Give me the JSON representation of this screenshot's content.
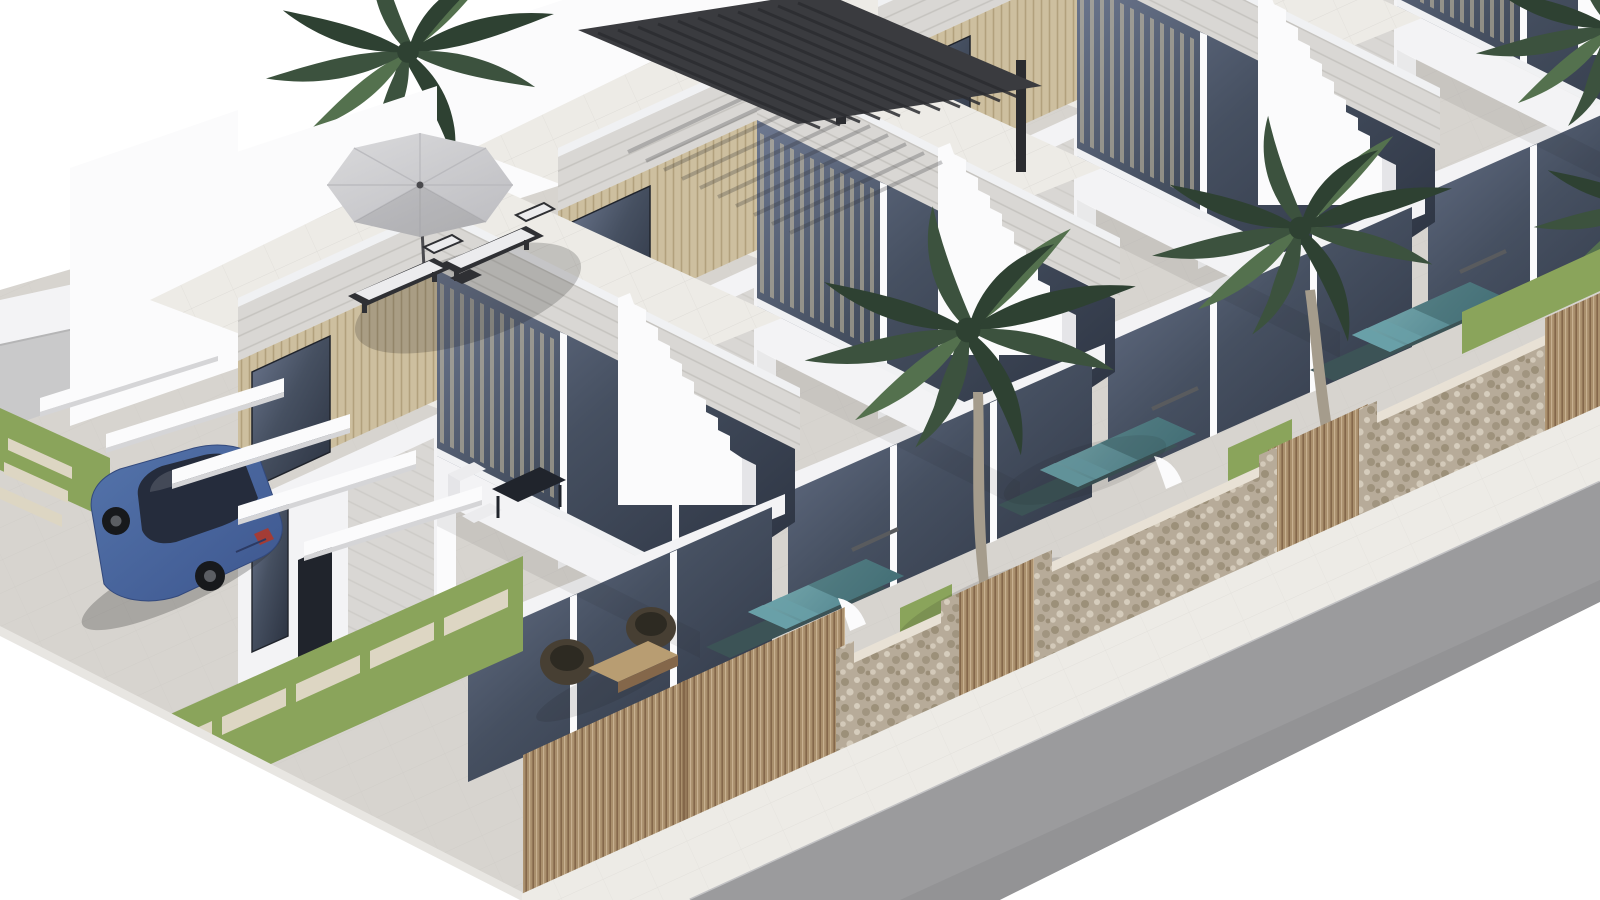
{
  "scene": {
    "type": "3d-architectural-render",
    "subject": "Row of four modern white two-storey villas with roof terraces, private plunge pools, palm trees, stone street walls, a parked blue car and a street in the lower right",
    "view": "isometric aerial",
    "house_count": 4,
    "palm_tree_count": 4,
    "visible_pool_count": 3,
    "wooden_gate_count": 4,
    "carport_beam_count": 5,
    "sun_lounger_count": 2,
    "patio_chair_count": 2
  },
  "objects": [
    {
      "name": "villa-1",
      "label": "front villa with umbrella roof terrace"
    },
    {
      "name": "villa-2",
      "label": "villa with black louvered roof pergola"
    },
    {
      "name": "villa-3",
      "label": "third villa"
    },
    {
      "name": "villa-4",
      "label": "fourth villa (partially visible)"
    },
    {
      "name": "roof-umbrella",
      "label": "gray parasol with two sun loungers"
    },
    {
      "name": "roof-pergola",
      "label": "black slatted pergola"
    },
    {
      "name": "plunge-pools",
      "label": "teal tiled pools with steps and waterfall walls"
    },
    {
      "name": "street-stone-wall",
      "label": "rubble stone boundary wall"
    },
    {
      "name": "wooden-gates",
      "label": "vertical slat timber gates"
    },
    {
      "name": "parked-car",
      "label": "blue sedan under white carport beams"
    },
    {
      "name": "street",
      "label": "gray asphalt road with white sidewalk"
    },
    {
      "name": "grass-strips",
      "label": "lawn strips with stepping pavers"
    }
  ],
  "colors": {
    "bg": "#ffffff",
    "ground": "#d7d4cf",
    "groundLine": "#c3c0bb",
    "road": "#9b9b9d",
    "roadDark": "#8e8e90",
    "sidewalk": "#edebe6",
    "curb": "#c2c2c4",
    "whiteEdge": "#e8e6e2",
    "grayWall": "#c9c9ca",
    "wallBright": "#fbfbfc",
    "wallWhite": "#f3f3f5",
    "wallShade": "#e5e5e8",
    "wallDark": "#d9d7d4",
    "fascia": "#d9d7d4",
    "fasciaLine": "#c5c3bf",
    "slatWood": "#cdbf9f",
    "slatLine": "#b2a17d",
    "curtain": "#d8cba9",
    "glass": "#465061",
    "glassDark": "#2b3240",
    "glassLight": "#6d7890",
    "frame": "#20242c",
    "frameLight": "#f0f1f3",
    "stone": "#b7ab99",
    "stoneDot": "#93876f",
    "stoneDotLight": "#dad1c1",
    "stoneCap": "#e8e1d5",
    "gateWood": "#a98f6c",
    "gateLine": "#84674a",
    "gateLight": "#c9b292",
    "grass": "#8aa45b",
    "paver": "#ddd6c3",
    "pool": "#4f828c",
    "poolLight": "#7fb0b4",
    "poolStep": "#69a0a8",
    "poolDark": "#35565c",
    "poolCoping": "#3c5356",
    "pergola": "#3a3b3f",
    "pergolaDark": "#2b2c30",
    "umbrella": "#dadadc",
    "umbrellaShade": "#bebec2",
    "pole": "#4a4a4e",
    "lounger": "#2f3034",
    "cushion": "#ececee",
    "rattan": "#473f33",
    "rattanDark": "#2d2a22",
    "tableWood": "#b89d72",
    "carBody": "#5474ab",
    "carBodyDark": "#3d568e",
    "carGlass": "#252c3c",
    "wheel": "#17191c",
    "hub": "#5b5e63",
    "tail": "#a33c35",
    "palm": "#3c523e",
    "palmLight": "#54714e",
    "palmDark": "#2e4132",
    "trunk": "#a59c8c",
    "trunkLine": "#8e8575",
    "shadow": "#1a1a1a"
  }
}
